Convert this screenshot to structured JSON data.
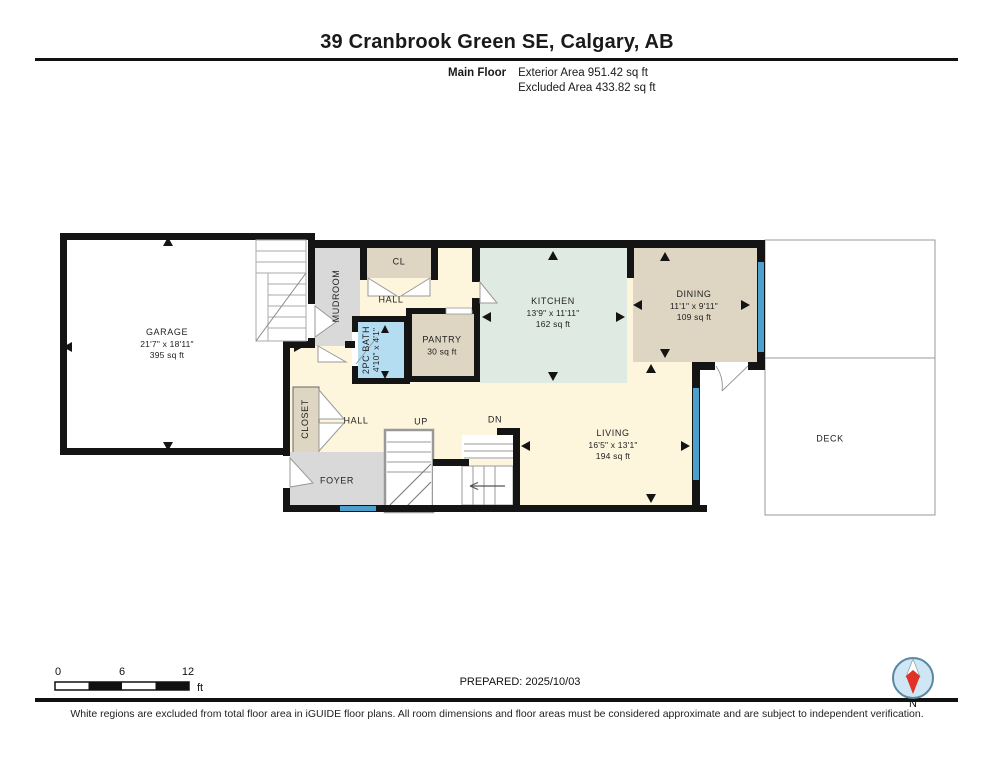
{
  "header": {
    "title": "39 Cranbrook Green SE, Calgary, AB",
    "floor_label": "Main Floor",
    "exterior_area": "Exterior Area 951.42 sq ft",
    "excluded_area": "Excluded Area 433.82 sq ft"
  },
  "rooms": {
    "garage": {
      "name": "GARAGE",
      "dims": "21'7\" x 18'11\"",
      "area": "395 sq ft"
    },
    "mudroom": {
      "name": "MUDROOM"
    },
    "cl": {
      "name": "CL"
    },
    "hall_upper": {
      "name": "HALL"
    },
    "bath": {
      "name": "2PC BATH",
      "dims": "4'10\" x 4'1\""
    },
    "pantry": {
      "name": "PANTRY",
      "area": "30 sq ft"
    },
    "kitchen": {
      "name": "KITCHEN",
      "dims": "13'9\" x 11'11\"",
      "area": "162 sq ft"
    },
    "dining": {
      "name": "DINING",
      "dims": "11'1\" x 9'11\"",
      "area": "109 sq ft"
    },
    "closet": {
      "name": "CLOSET"
    },
    "hall_lower": {
      "name": "HALL"
    },
    "stairs_up": {
      "name": "UP"
    },
    "stairs_down": {
      "name": "DN"
    },
    "living": {
      "name": "LIVING",
      "dims": "16'5\" x 13'1\"",
      "area": "194 sq ft"
    },
    "foyer": {
      "name": "FOYER"
    },
    "deck": {
      "name": "DECK"
    }
  },
  "scale_bar": {
    "ticks": [
      "0",
      "6",
      "12"
    ],
    "unit": "ft"
  },
  "footer": {
    "prepared": "PREPARED: 2025/10/03",
    "compass_label": "N",
    "disclaimer": "White regions are excluded from total floor area in iGUIDE floor plans. All room dimensions and floor areas must be considered approximate and are subject to independent verification."
  },
  "colors": {
    "room_tan": "#ded5c2",
    "room_cream": "#fdf5dc",
    "room_mint": "#dfeae3",
    "room_gray": "#d9d9d9",
    "room_blue": "#b5ddf2",
    "window_blue": "#4d9fcc",
    "wall_black": "#141414",
    "compass_red": "#e03226",
    "compass_blue": "#cfe6f5"
  }
}
